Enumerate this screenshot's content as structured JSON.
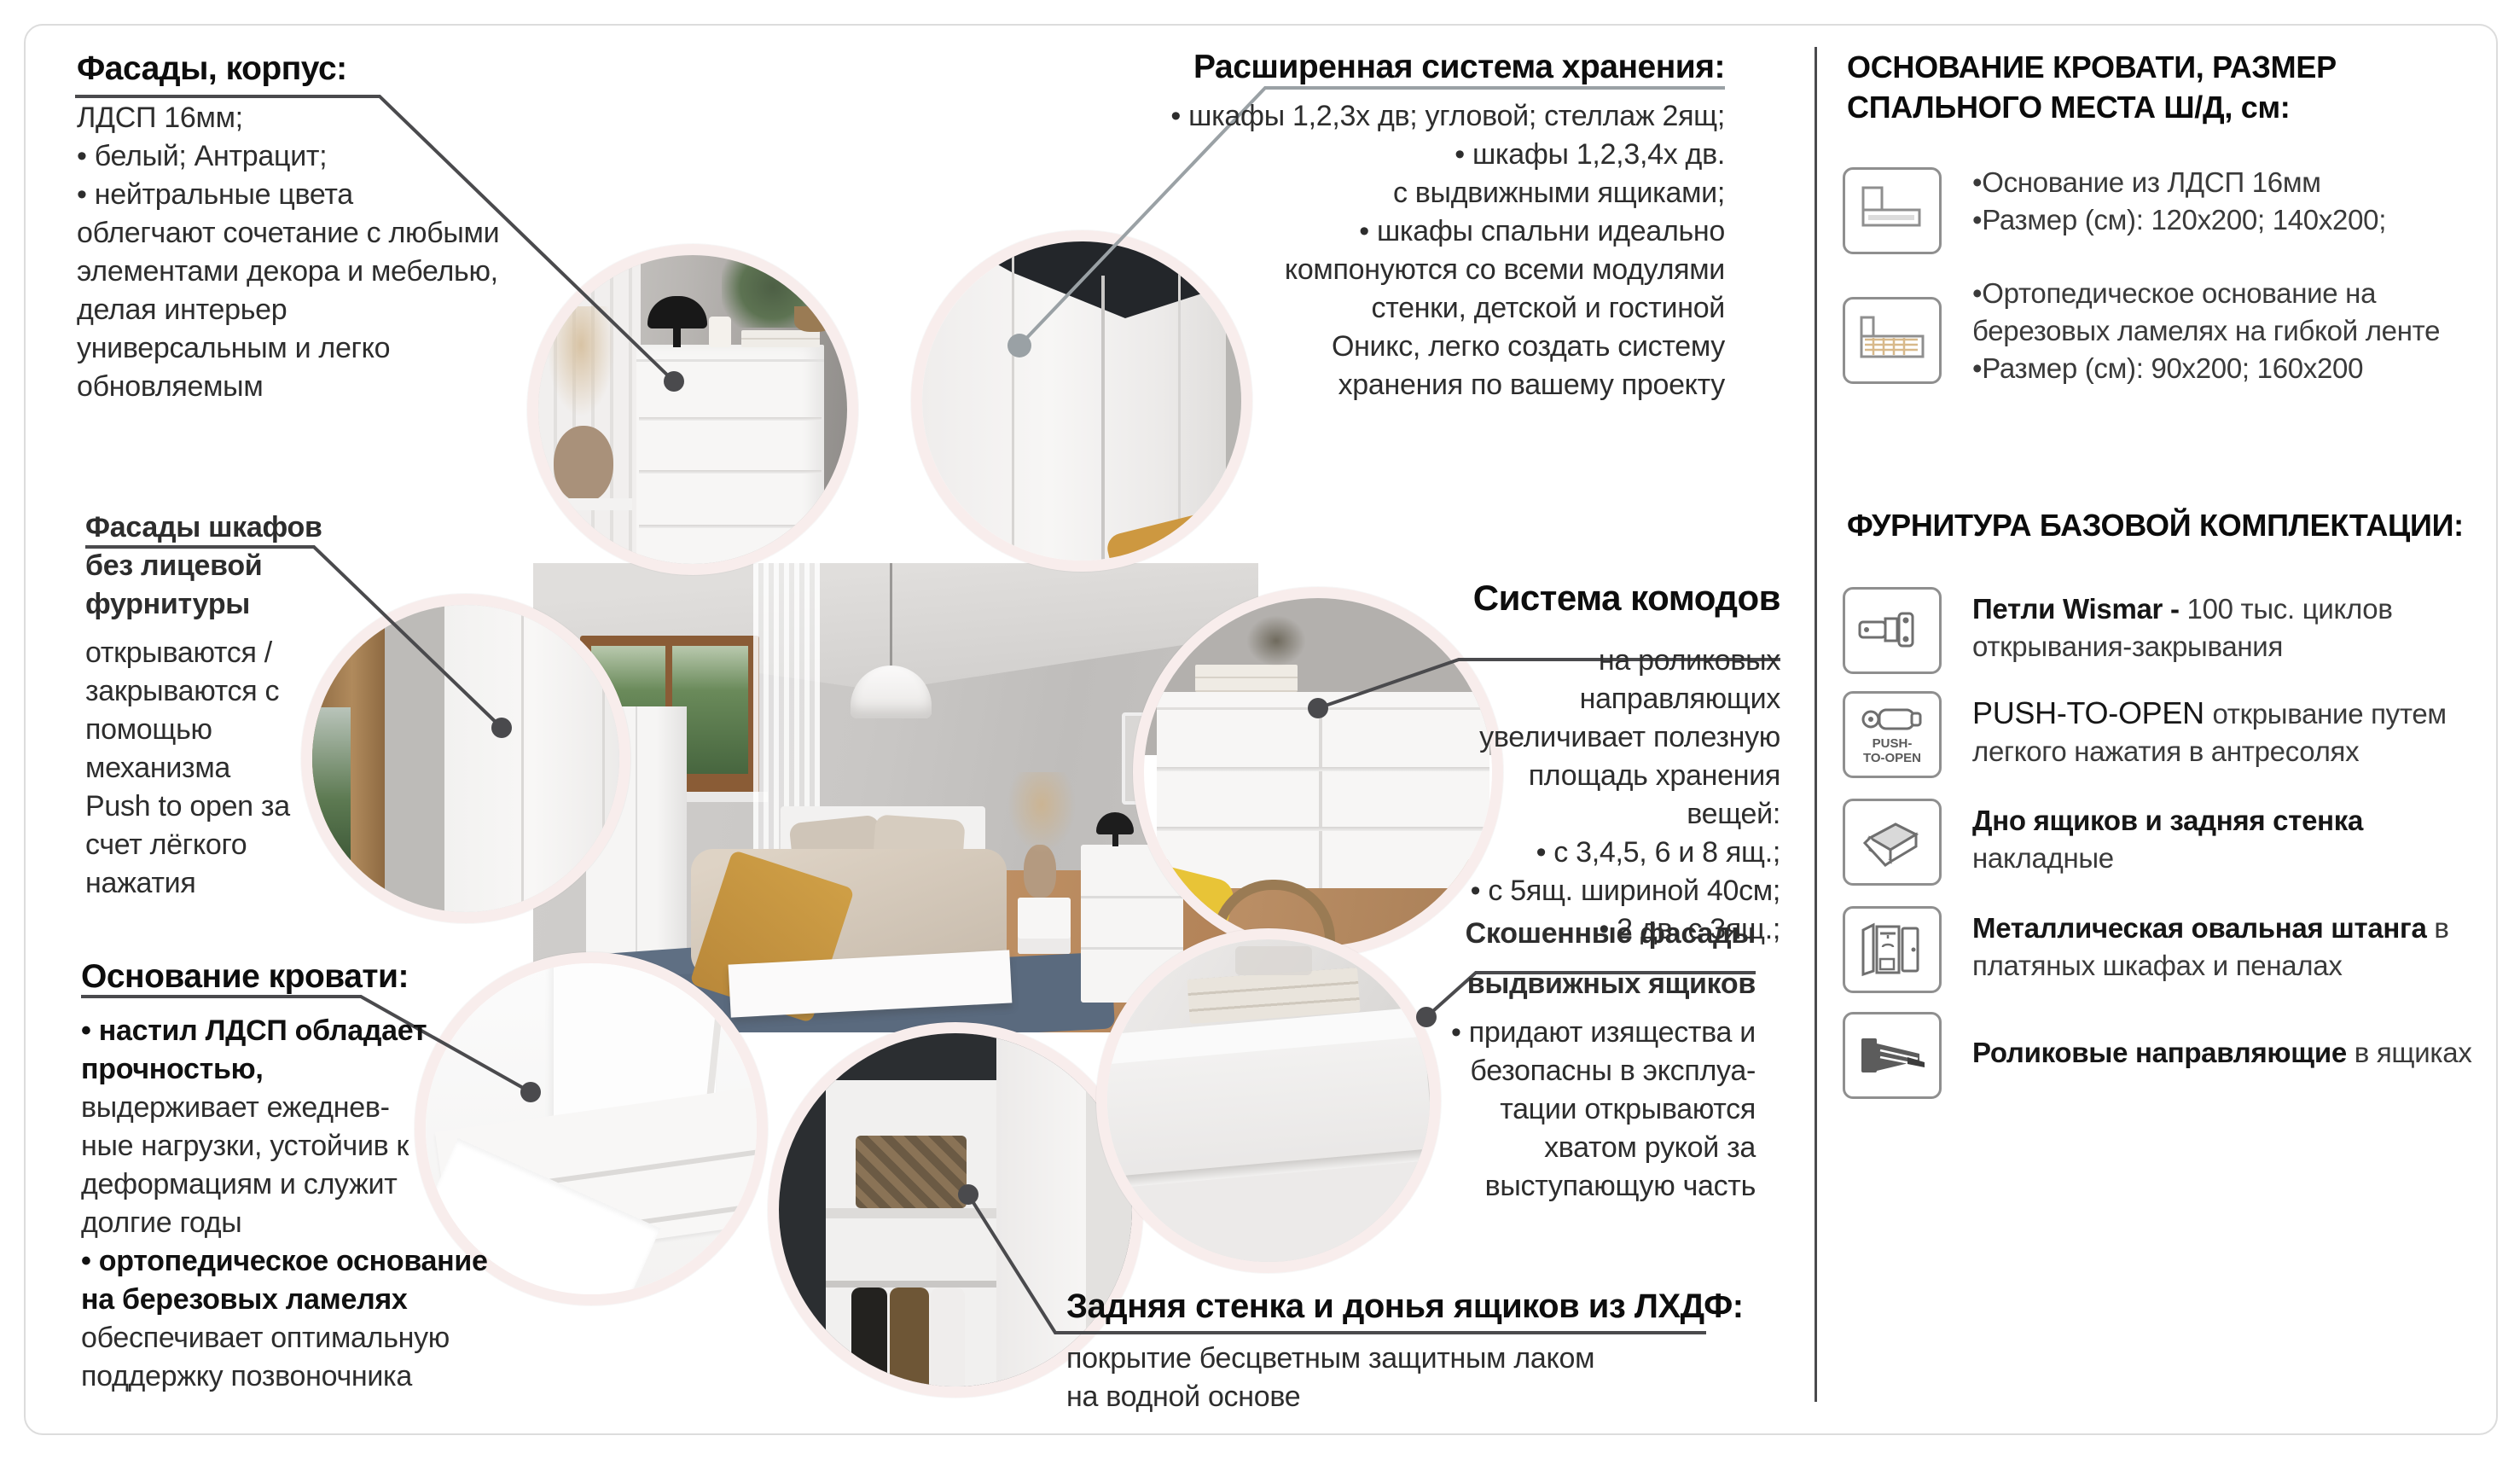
{
  "colors": {
    "leader_dark": "#4a4a4d",
    "leader_light": "#9aa1a5",
    "circle_rim": "#f8edec",
    "frame_border": "#dcdcdc",
    "accent_throw": "#c49440",
    "rug_blue": "#5f6f83"
  },
  "blocks": {
    "facades_corpus": {
      "title": "Фасады, корпус:",
      "lines": [
        "ЛДСП 16мм;",
        "• белый; Антрацит;",
        "• нейтральные цвета",
        "облегчают сочетание с любыми",
        "элементами декора и мебелью,",
        "делая интерьер",
        "универсальным и легко",
        "обновляемым"
      ]
    },
    "storage_system": {
      "title": "Расширенная система хранения:",
      "lines": [
        "• шкафы 1,2,3х дв; угловой; стеллаж 2ящ;",
        "• шкафы 1,2,3,4х дв.",
        "с выдвижными ящиками;",
        "• шкафы спальни идеально",
        "компонуются со всеми модулями",
        "стенки, детской и гостиной",
        "Оникс, легко создать систему",
        "хранения по вашему проекту"
      ]
    },
    "wardrobe_facades": {
      "title_lines": [
        "Фасады шкафов",
        "без лицевой",
        "фурнитуры"
      ],
      "lines": [
        "открываются /",
        "закрываются с",
        "помощью",
        "механизма",
        "Push to open за",
        "счет лёгкого",
        "нажатия"
      ]
    },
    "drawer_system": {
      "title": "Система комодов",
      "lines": [
        "на роликовых",
        "направляющих",
        "увеличивает полезную",
        "площадь хранения",
        "вещей:",
        "• с 3,4,5, 6 и 8 ящ.;",
        "• с 5ящ. шириной 40см;",
        "• 2 дв. с 3ящ.;"
      ]
    },
    "bed_base": {
      "title": "Основание кровати:",
      "lines": [
        "• настил ЛДСП обладает",
        "прочностью,",
        "выдерживает ежеднев-",
        "ные нагрузки, устойчив к",
        "деформациям и служит",
        "долгие годы",
        "• ортопедическое основание",
        "на березовых ламелях",
        "обеспечивает оптимальную",
        "поддержку позвоночника"
      ]
    },
    "slanted_facades": {
      "title_lines": [
        "Скошенные фасады",
        "выдвижных ящиков"
      ],
      "lines": [
        "• придают изящества и",
        "безопасны в эксплуа-",
        "тации открываются",
        "хватом рукой за",
        "выступающую часть"
      ]
    },
    "back_wall": {
      "title": "Задняя стенка и донья ящиков из ЛХДФ:",
      "lines": [
        "покрытие бесцветным защитным лаком",
        "на водной основе"
      ]
    }
  },
  "panel": {
    "bed_section": {
      "title_lines": [
        "ОСНОВАНИЕ КРОВАТИ, РАЗМЕР",
        "СПАЛЬНОГО МЕСТА Ш/Д, см:"
      ],
      "items": [
        {
          "icon": "bed-base-icon",
          "lines": [
            "•Основание из ЛДСП 16мм",
            "•Размер (см): 120x200; 140x200;"
          ]
        },
        {
          "icon": "bed-slats-icon",
          "lines": [
            "•Ортопедическое основание на",
            "березовых ламелях на гибкой ленте",
            "•Размер (см): 90x200; 160x200"
          ]
        }
      ]
    },
    "hardware_section": {
      "title": "ФУРНИТУРА БАЗОВОЙ КОМПЛЕКТАЦИИ:",
      "items": [
        {
          "icon": "hinge-icon",
          "strong": "Петли Wismar - ",
          "rest": "100 тыс. циклов открывания-закрывания"
        },
        {
          "icon": "push-to-open-icon",
          "badge_line1": "PUSH-",
          "badge_line2": "TO-OPEN",
          "strong": "PUSH-TO-OPEN ",
          "rest": "открывание путем легкого нажатия в антресолях"
        },
        {
          "icon": "drawer-bottom-icon",
          "strong": "Дно ящиков и задняя стенка ",
          "rest": "накладные"
        },
        {
          "icon": "wardrobe-rod-icon",
          "strong": "Металлическая овальная штанга ",
          "rest": "в платяных шкафах и пеналах"
        },
        {
          "icon": "roller-guides-icon",
          "strong": "Роликовые направляющие ",
          "rest": "в ящиках"
        }
      ]
    }
  }
}
